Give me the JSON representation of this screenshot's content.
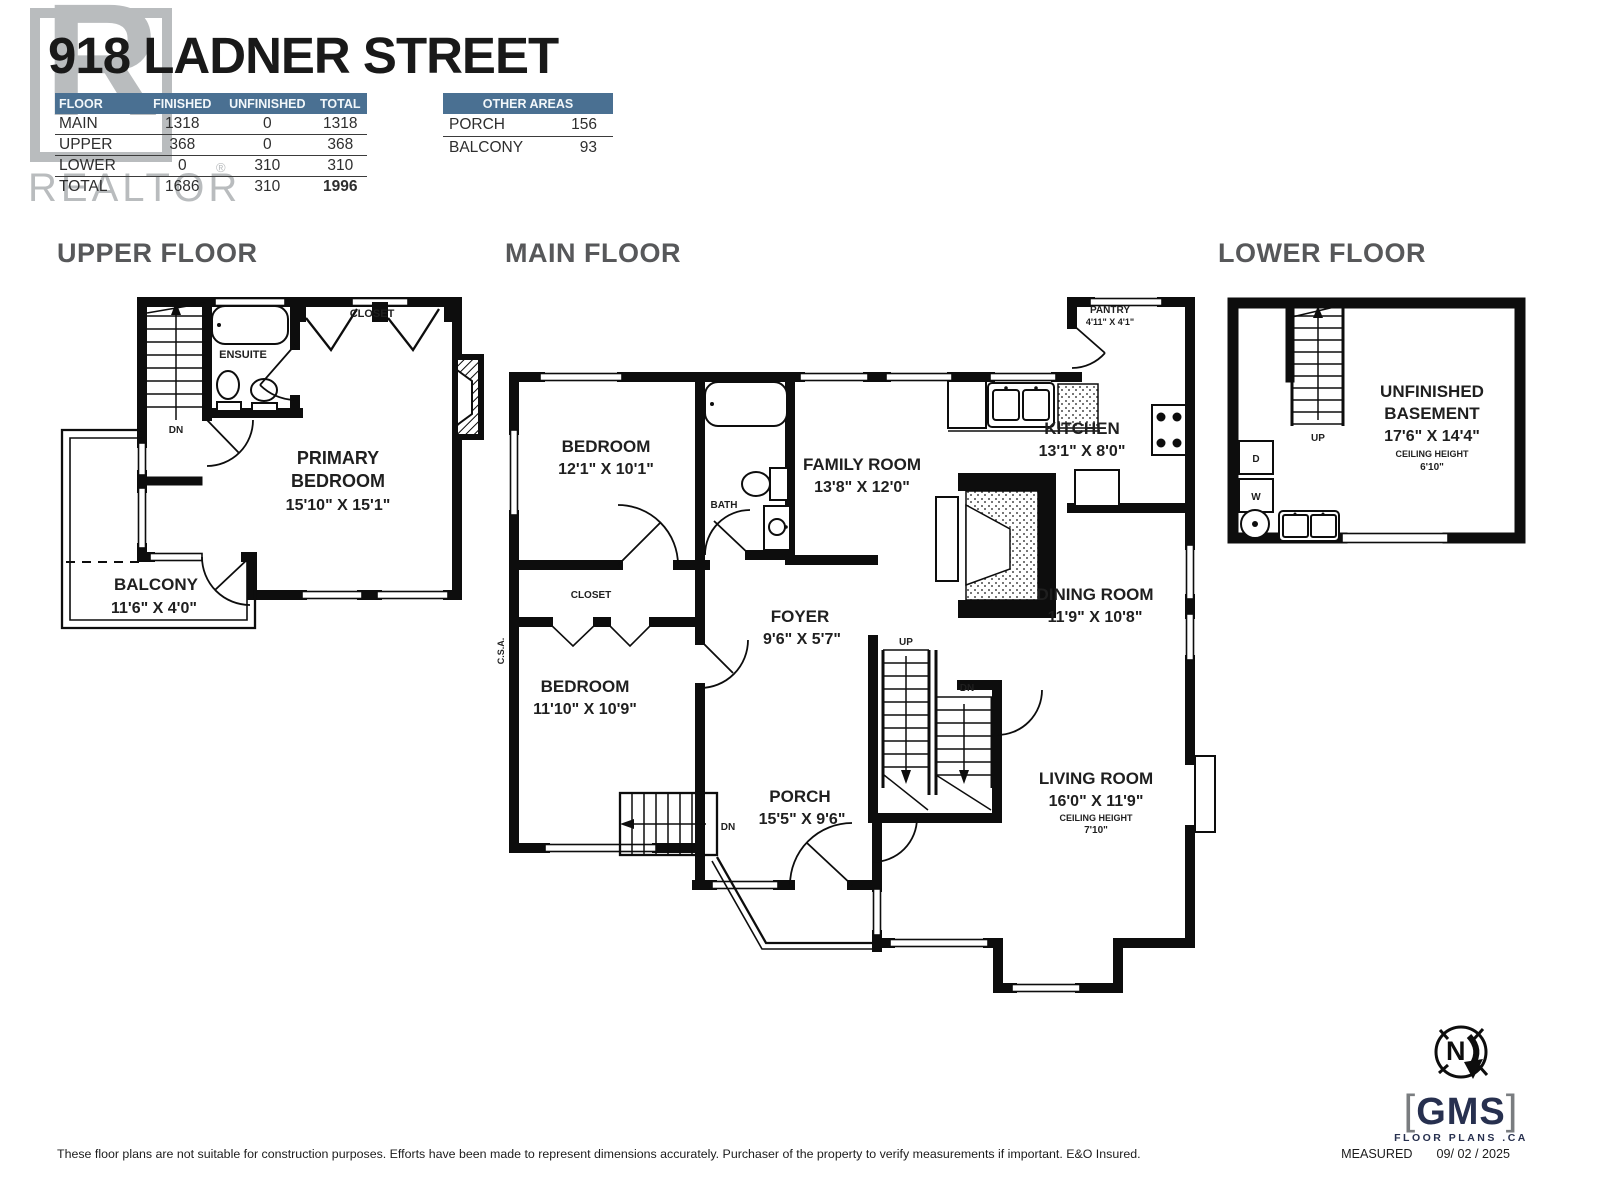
{
  "page": {
    "accent_blue": "#4a7092",
    "heading_gray": "#57585a",
    "watermark_gray": "#b9bcbe",
    "navy": "#27304f"
  },
  "header": {
    "title": "918 LADNER STREET",
    "watermark_letter": "R",
    "watermark_word": "REALTOR",
    "watermark_reg": "®",
    "area_table": {
      "columns": [
        "FLOOR",
        "FINISHED",
        "UNFINISHED",
        "TOTAL"
      ],
      "rows": [
        [
          "MAIN",
          "1318",
          "0",
          "1318"
        ],
        [
          "UPPER",
          "368",
          "0",
          "368"
        ],
        [
          "LOWER",
          "0",
          "310",
          "310"
        ],
        [
          "TOTAL",
          "1686",
          "310",
          "1996"
        ]
      ]
    },
    "other_areas": {
      "title": "OTHER AREAS",
      "rows": [
        [
          "PORCH",
          "156"
        ],
        [
          "BALCONY",
          "93"
        ]
      ]
    }
  },
  "sections": {
    "upper": "UPPER FLOOR",
    "main": "MAIN FLOOR",
    "lower": "LOWER FLOOR"
  },
  "upper": {
    "ensuite": "ENSUITE",
    "closet": "CLOSET",
    "dn": "DN",
    "primary_l1": "PRIMARY",
    "primary_l2": "BEDROOM",
    "primary_dims": "15'10\" X 15'1\"",
    "balcony": "BALCONY",
    "balcony_dims": "11'6\" X 4'0\""
  },
  "main": {
    "bedroom1": "BEDROOM",
    "bedroom1_dims": "12'1\" X 10'1\"",
    "bath": "BATH",
    "closet": "CLOSET",
    "bedroom2": "BEDROOM",
    "bedroom2_dims": "11'10\" X 10'9\"",
    "family": "FAMILY ROOM",
    "family_dims": "13'8\" X 12'0\"",
    "kitchen": "KITCHEN",
    "kitchen_dims": "13'1\" X 8'0\"",
    "pantry": "PANTRY",
    "pantry_dims": "4'11\" X 4'1\"",
    "dining": "DINING ROOM",
    "dining_dims": "11'9\" X 10'8\"",
    "living": "LIVING ROOM",
    "living_dims": "16'0\" X 11'9\"",
    "ceiling_label": "CEILING HEIGHT",
    "living_ch": "7'10\"",
    "foyer": "FOYER",
    "foyer_dims": "9'6\" X 5'7\"",
    "porch": "PORCH",
    "porch_dims": "15'5\" X 9'6\"",
    "up": "UP",
    "dn": "DN",
    "dn_porch": "DN",
    "csa": "C.S.A."
  },
  "lower": {
    "room_l1": "UNFINISHED",
    "room_l2": "BASEMENT",
    "room_dims": "17'6\" X 14'4\"",
    "ceiling_label": "CEILING HEIGHT",
    "ceiling": "6'10\"",
    "up": "UP",
    "dryer": "D",
    "washer": "W"
  },
  "footer": {
    "disclaimer": "These floor plans are not suitable for construction purposes. Efforts have been made to represent dimensions accurately.  Purchaser of the property to verify measurements if important.  E&O Insured.",
    "measured_label": "MEASURED",
    "measured_date": "09/ 02 / 2025"
  },
  "logo": {
    "bracket_left": "[",
    "name": "GMS",
    "bracket_right": "]",
    "tagline": "FLOOR PLANS .CA",
    "compass_n": "N"
  }
}
